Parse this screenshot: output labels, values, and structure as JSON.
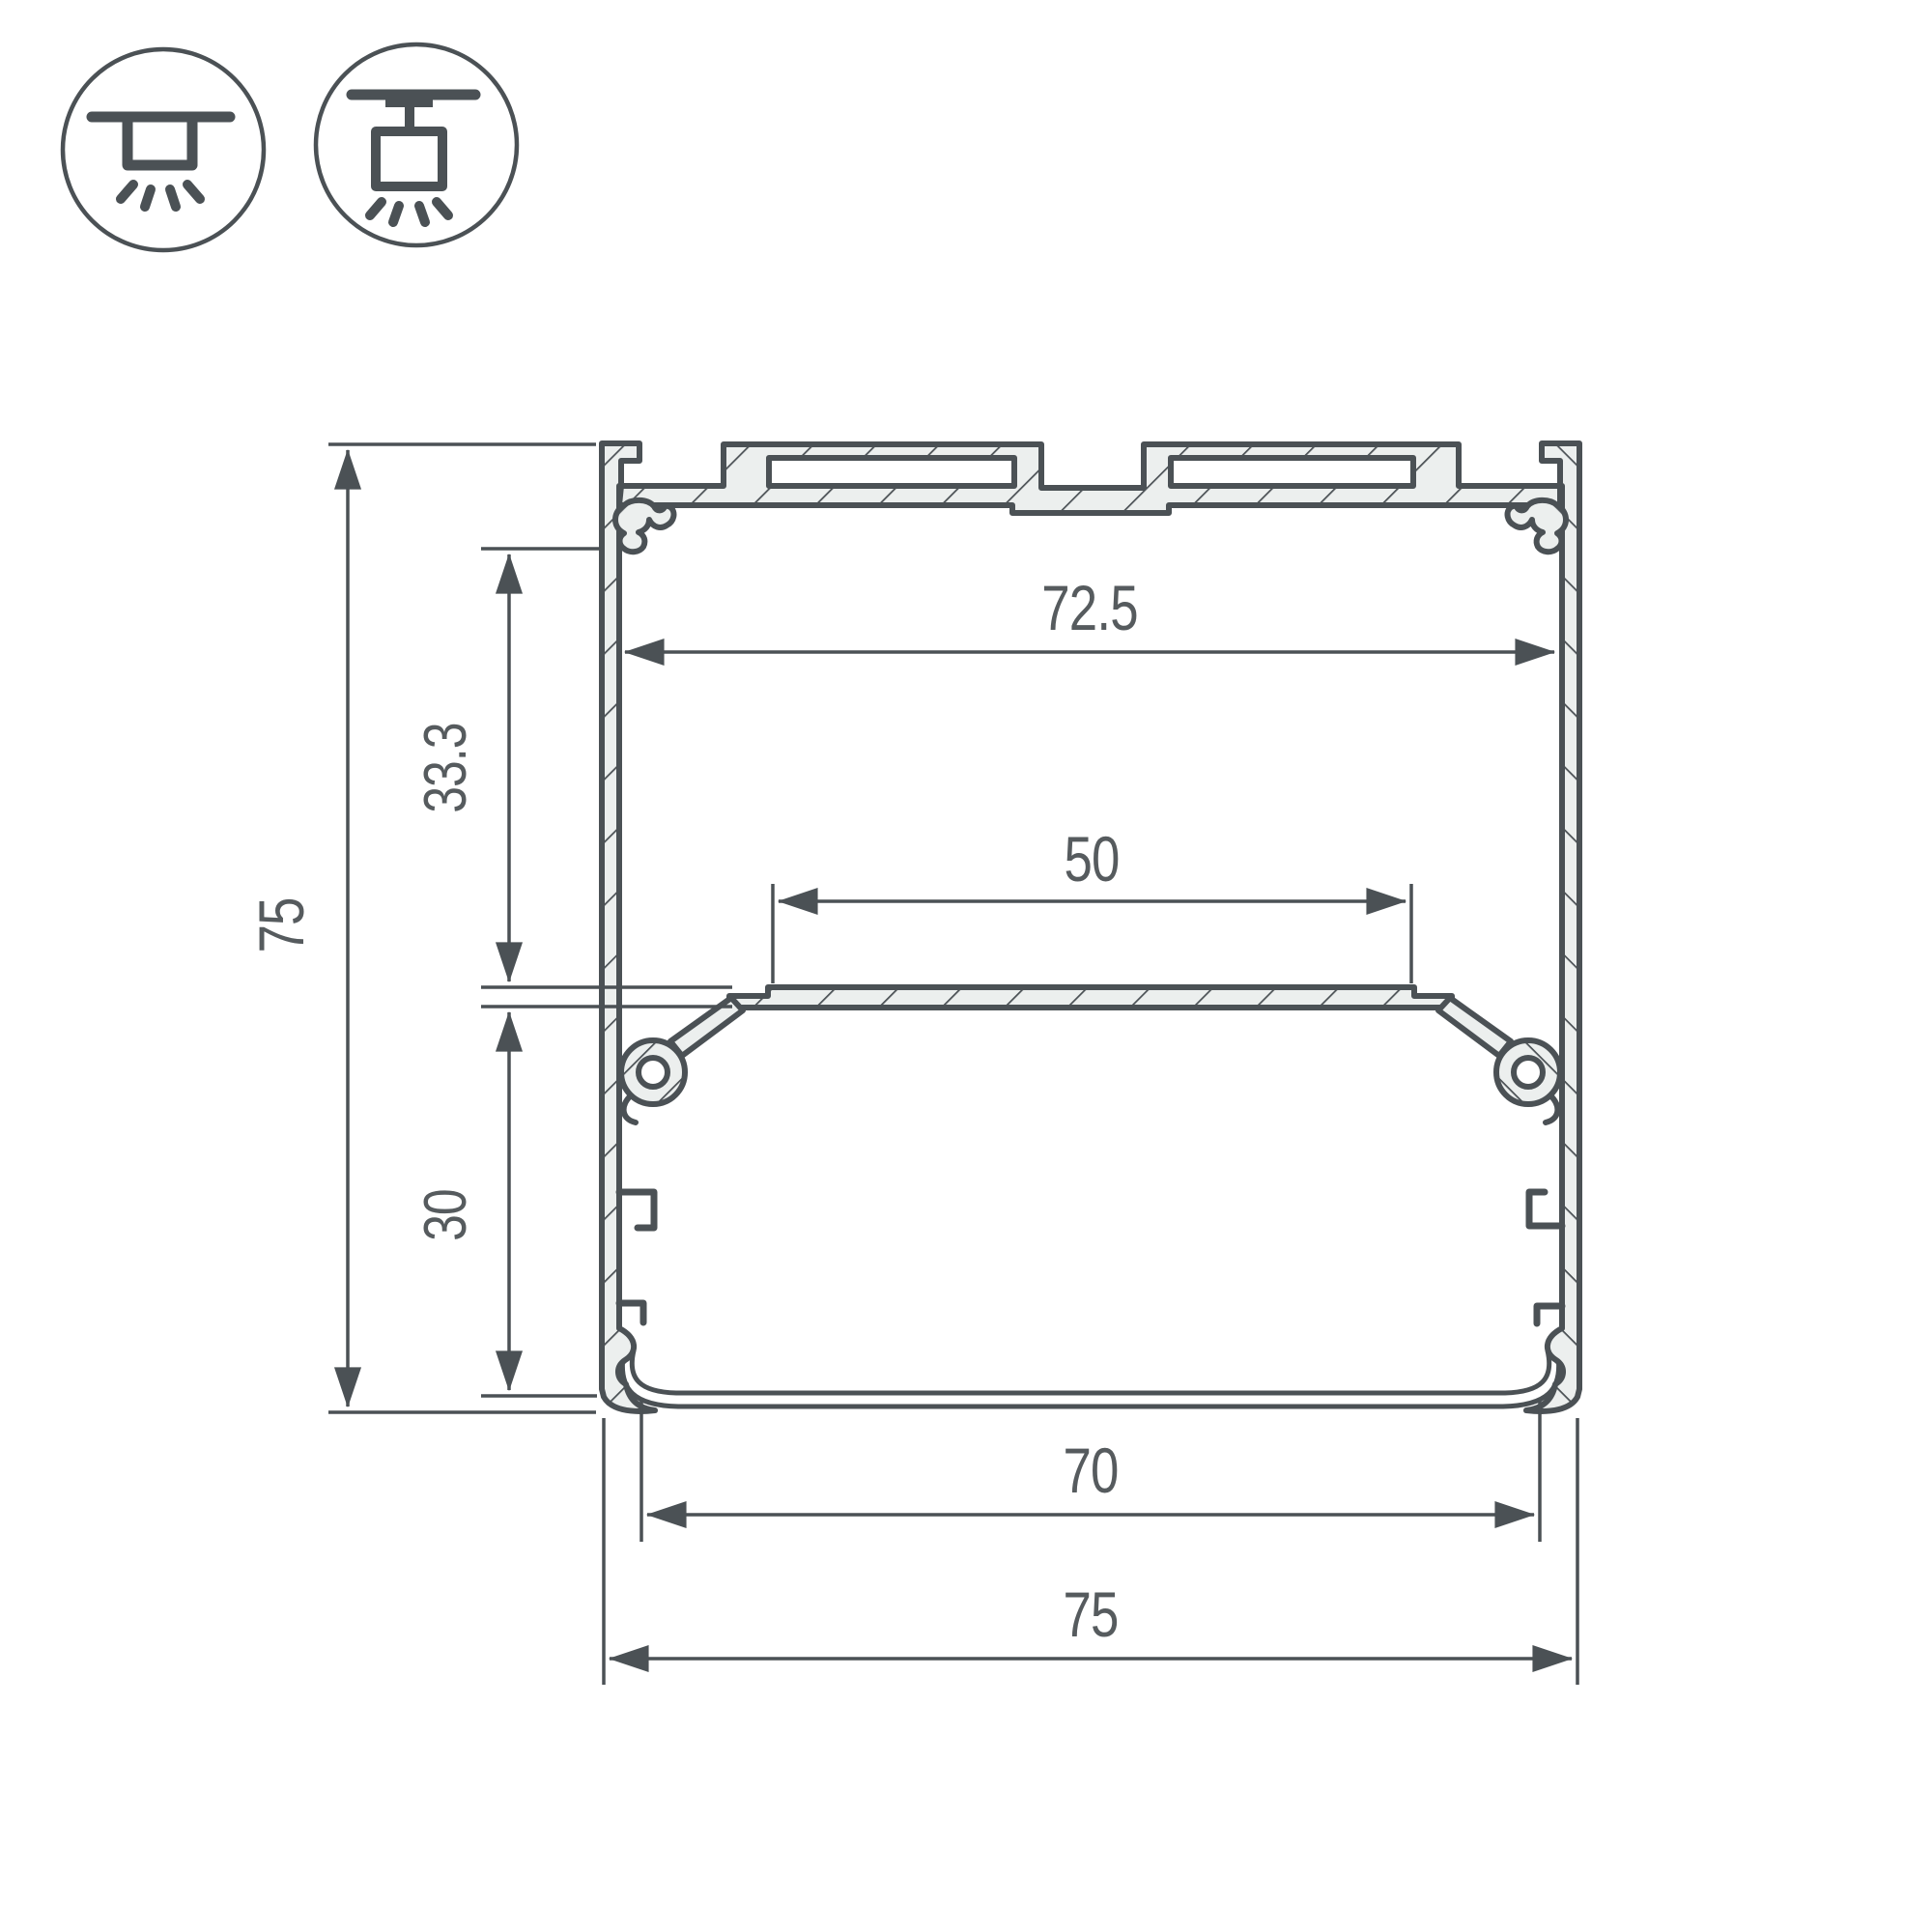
{
  "drawing": {
    "type": "profile-cross-section",
    "units_shown": false
  },
  "colors": {
    "line": "#4b5155",
    "text": "#565b5e",
    "aluminum_fill": "#ecefee",
    "diffuser_fill": "#ffffff",
    "background": "#ffffff"
  },
  "mount_icons": [
    {
      "name": "surface-ceiling-mount-icon"
    },
    {
      "name": "suspended-pendant-mount-icon"
    }
  ],
  "dimensions": {
    "overall_height": "75",
    "upper_inner_offset": "33.3",
    "lower_inner_offset": "30",
    "inner_width_top": "72.5",
    "led_shelf_width": "50",
    "bottom_opening_width": "70",
    "overall_width": "75"
  }
}
